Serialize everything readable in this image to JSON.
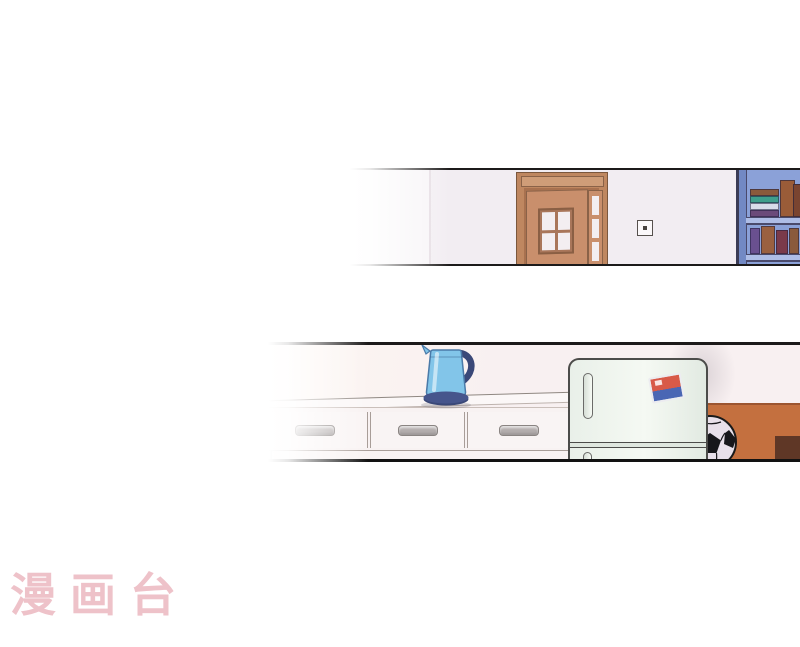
{
  "page": {
    "watermark_text": "漫画台"
  },
  "scene": {
    "top_panel_objects": [
      "wall",
      "wooden-door-open",
      "transom-window",
      "door-sidelight",
      "wall-switch",
      "bookshelf-with-books"
    ],
    "bottom_panel_objects": [
      "kitchen-counter-drawers",
      "electric-kettle",
      "refrigerator",
      "fridge-magnet-sticker",
      "soccer-ball",
      "orange-wall",
      "dark-ledge",
      "yellow-object"
    ]
  },
  "colors": {
    "bg": "#ffffff",
    "line": "#1c1a1a",
    "wall1": "#f2edf2",
    "wall2": "#f8f0f1",
    "doorframe": "#bf8760",
    "door": "#c98f6c",
    "shelf": "#8ba1d8",
    "orange": "#c4703f",
    "darkwood": "#5f3726",
    "counter": "#f8f2f2",
    "handle": "#b3adad",
    "kettle_body": "#82c5e9",
    "kettle_dark": "#3a4878",
    "fridge_body": "#eff5ef",
    "sticker_red": "#d85a48",
    "sticker_blue": "#4a66b4",
    "ball_white": "#e8e0ea",
    "ball_black": "#17171b",
    "watermark": "#eec2c9"
  },
  "book_colors": {
    "stack": [
      "#8a5a3c",
      "#3f9e8c",
      "#d8dcea",
      "#6a4a7a"
    ],
    "standing": [
      "#6a5090",
      "#9a6040",
      "#7a3a4a",
      "#8a5a3c"
    ]
  }
}
